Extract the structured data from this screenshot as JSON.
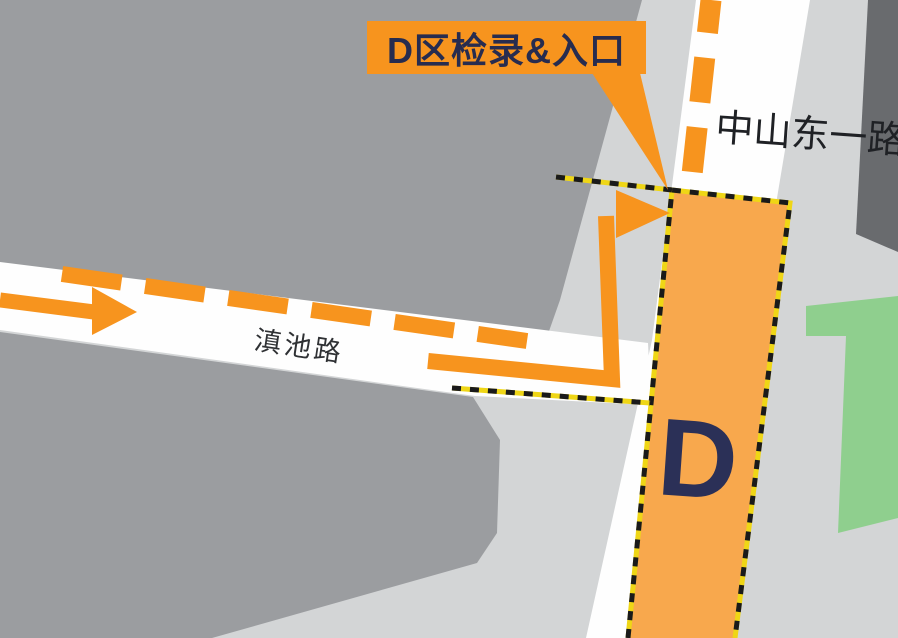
{
  "callout": {
    "text": "D区检录&入口"
  },
  "roads": {
    "vertical_name": "中山东一路",
    "horizontal_name": "滇池路"
  },
  "zone": {
    "letter": "D"
  },
  "colors": {
    "route_orange": "#F7941E",
    "zone_orange": "#F8A84D",
    "navy": "#2B3057",
    "callout_text": "#272C4F",
    "road_text": "#1F2125",
    "block_gray": "#9B9DA0",
    "dark_gray": "#696B6E",
    "canvas_gray": "#D3D5D6",
    "road_white": "#FEFEFE",
    "green": "#8FCF8E",
    "border_yellow": "#EFD616",
    "border_black": "#1A1A1A"
  }
}
